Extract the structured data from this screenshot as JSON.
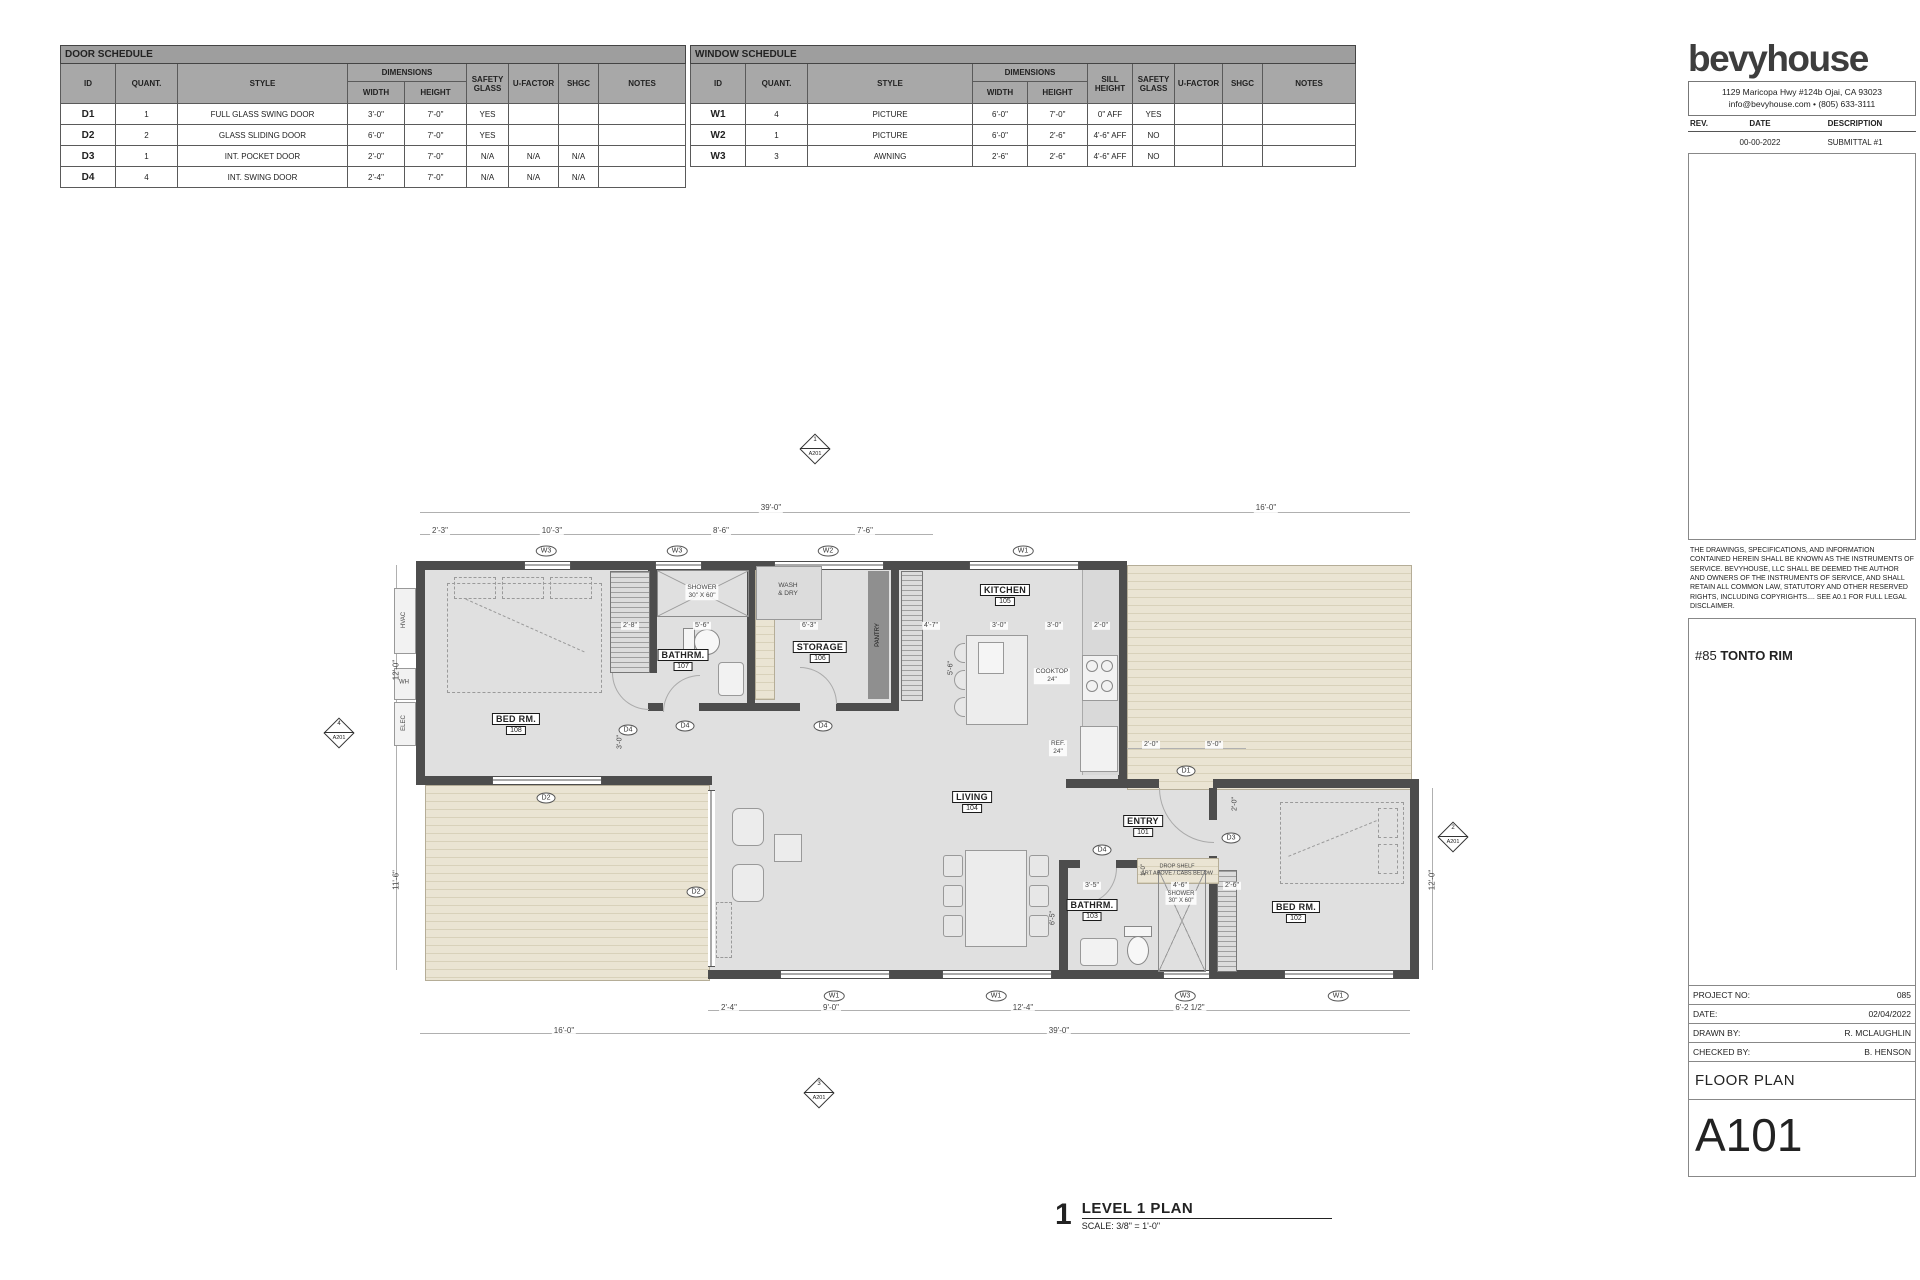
{
  "door_schedule": {
    "title": "DOOR SCHEDULE",
    "col_id": "ID",
    "col_quant": "QUANT.",
    "col_style": "STYLE",
    "col_dimensions": "DIMENSIONS",
    "col_width": "WIDTH",
    "col_height": "HEIGHT",
    "col_safety": "SAFETY GLASS",
    "col_ufactor": "U-FACTOR",
    "col_shgc": "SHGC",
    "col_notes": "NOTES",
    "rows": [
      {
        "id": "D1",
        "quant": "1",
        "style": "FULL GLASS SWING DOOR",
        "width": "3'-0\"",
        "height": "7'-0\"",
        "safety": "YES",
        "ufactor": "",
        "shgc": "",
        "notes": ""
      },
      {
        "id": "D2",
        "quant": "2",
        "style": "GLASS SLIDING DOOR",
        "width": "6'-0\"",
        "height": "7'-0\"",
        "safety": "YES",
        "ufactor": "",
        "shgc": "",
        "notes": ""
      },
      {
        "id": "D3",
        "quant": "1",
        "style": "INT. POCKET DOOR",
        "width": "2'-0\"",
        "height": "7'-0\"",
        "safety": "N/A",
        "ufactor": "N/A",
        "shgc": "N/A",
        "notes": ""
      },
      {
        "id": "D4",
        "quant": "4",
        "style": "INT. SWING DOOR",
        "width": "2'-4\"",
        "height": "7'-0\"",
        "safety": "N/A",
        "ufactor": "N/A",
        "shgc": "N/A",
        "notes": ""
      }
    ]
  },
  "window_schedule": {
    "title": "WINDOW SCHEDULE",
    "col_id": "ID",
    "col_quant": "QUANT.",
    "col_style": "STYLE",
    "col_dimensions": "DIMENSIONS",
    "col_width": "WIDTH",
    "col_height": "HEIGHT",
    "col_sill": "SILL HEIGHT",
    "col_safety": "SAFETY GLASS",
    "col_ufactor": "U-FACTOR",
    "col_shgc": "SHGC",
    "col_notes": "NOTES",
    "rows": [
      {
        "id": "W1",
        "quant": "4",
        "style": "PICTURE",
        "width": "6'-0\"",
        "height": "7'-0\"",
        "sill": "0\" AFF",
        "safety": "YES",
        "ufactor": "",
        "shgc": "",
        "notes": ""
      },
      {
        "id": "W2",
        "quant": "1",
        "style": "PICTURE",
        "width": "6'-0\"",
        "height": "2'-6\"",
        "sill": "4'-6\" AFF",
        "safety": "NO",
        "ufactor": "",
        "shgc": "",
        "notes": ""
      },
      {
        "id": "W3",
        "quant": "3",
        "style": "AWNING",
        "width": "2'-6\"",
        "height": "2'-6\"",
        "sill": "4'-6\" AFF",
        "safety": "NO",
        "ufactor": "",
        "shgc": "",
        "notes": ""
      }
    ]
  },
  "title_block": {
    "logo": "bevyhouse",
    "address": "1129 Maricopa Hwy #124b Ojai, CA 93023",
    "contact": "info@bevyhouse.com  •  (805) 633-3111",
    "rev_col": "REV.",
    "date_col": "DATE",
    "desc_col": "DESCRIPTION",
    "rev_date": "00-00-2022",
    "rev_desc": "SUBMITTAL #1",
    "disclaimer": "THE DRAWINGS, SPECIFICATIONS, AND INFORMATION CONTAINED HEREIN SHALL BE KNOWN AS THE INSTRUMENTS OF SERVICE. BEVYHOUSE, LLC SHALL BE DEEMED THE AUTHOR AND OWNERS OF THE INSTRUMENTS OF SERVICE, AND SHALL RETAIN ALL COMMON LAW, STATUTORY AND OTHER RESERVED RIGHTS, INCLUDING COPYRIGHTS.... SEE A0.1 FOR FULL LEGAL DISCLAIMER.",
    "project_name": "#85 TONTO RIM",
    "project_no_label": "PROJECT NO:",
    "project_no": "085",
    "date_label": "DATE:",
    "date": "02/04/2022",
    "drawn_label": "DRAWN BY:",
    "drawn": "R. MCLAUGHLIN",
    "checked_label": "CHECKED BY:",
    "checked": "B. HENSON",
    "sheet_title": "FLOOR PLAN",
    "sheet_no": "A101"
  },
  "plan": {
    "view_no": "1",
    "view_title": "LEVEL 1 PLAN",
    "view_scale": "SCALE:  3/8\" = 1'-0\"",
    "rooms": {
      "entry": {
        "name": "ENTRY",
        "num": "101"
      },
      "bed2": {
        "name": "BED RM.",
        "num": "102"
      },
      "bath2": {
        "name": "BATHRM.",
        "num": "103"
      },
      "living": {
        "name": "LIVING",
        "num": "104"
      },
      "kitchen": {
        "name": "KITCHEN",
        "num": "105"
      },
      "storage": {
        "name": "STORAGE",
        "num": "106"
      },
      "bath1": {
        "name": "BATHRM.",
        "num": "107"
      },
      "bed1": {
        "name": "BED RM.",
        "num": "108"
      }
    },
    "labels": {
      "hvac": "HVAC",
      "wh": "WH",
      "elec": "ELEC",
      "wash1": "WASH",
      "wash2": "& DRY",
      "shower": "SHOWER",
      "shower_size": "30\" X 60\"",
      "pantry": "PANTRY",
      "cooktop": "COOKTOP",
      "cooktop_size": "24\"",
      "ref": "REF.",
      "ref_size": "24\"",
      "drop1": "DROP SHELF",
      "drop2": "ART ABOVE / CABS BELOW"
    },
    "tags": {
      "w1": "W1",
      "w2": "W2",
      "w3": "W3",
      "d1": "D1",
      "d2": "D2",
      "d3": "D3",
      "d4": "D4"
    },
    "dims": {
      "t39": "39'-0\"",
      "t16": "16'-0\"",
      "t2_3": "2'-3\"",
      "t10_3": "10'-3\"",
      "t8_6": "8'-6\"",
      "t7_6": "7'-6\"",
      "l12": "12'-0\"",
      "l11_6": "11'-6\"",
      "r12": "12'-0\"",
      "b2_4": "2'-4\"",
      "b9": "9'-0\"",
      "b12_4": "12'-4\"",
      "b6_2": "6'-2 1/2\"",
      "b16": "16'-0\"",
      "b39": "39'-0\"",
      "i2_8": "2'-8\"",
      "i5_6": "5'-6\"",
      "i6_3": "6'-3\"",
      "i4_7": "4'-7\"",
      "k3a": "3'-0\"",
      "k3b": "3'-0\"",
      "k2": "2'-0\"",
      "v5_6": "5'-6\"",
      "v3": "3'-0\"",
      "v6_5": "6'-5\"",
      "v1": "1'-0\"",
      "v2": "2'-0\"",
      "d2": "2'-0\"",
      "d5": "5'-0\"",
      "bt3_5": "3'-5\"",
      "bt4_6": "4'-6\"",
      "bt2_6": "2'-6\""
    },
    "markers": {
      "top": {
        "num": "1",
        "sheet": "A201"
      },
      "right": {
        "num": "2",
        "sheet": "A201"
      },
      "bottom": {
        "num": "3",
        "sheet": "A201"
      },
      "left": {
        "num": "4",
        "sheet": "A201"
      }
    }
  }
}
